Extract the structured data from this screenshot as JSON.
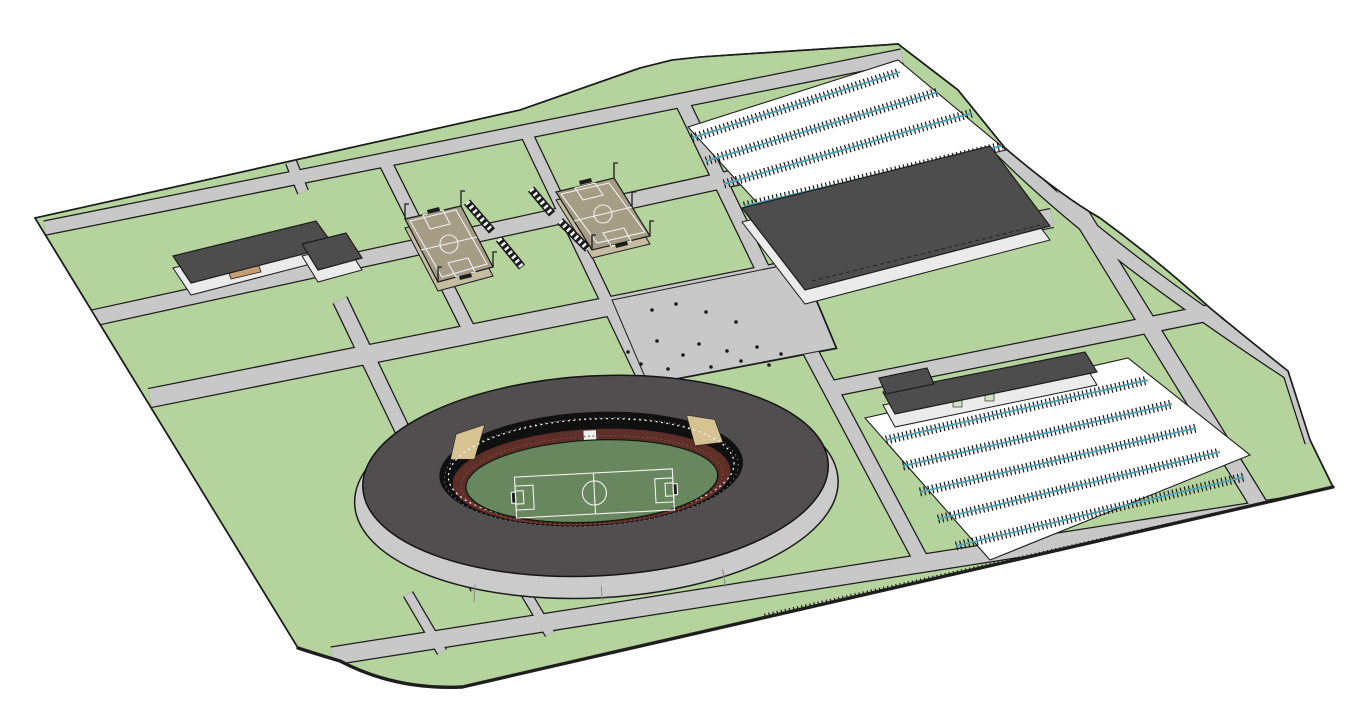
{
  "meta": {
    "title": "Sports complex site plan - 3D model view",
    "view": "axonometric aerial",
    "background_note": "white void around site parcel"
  },
  "colors": {
    "background": "#ffffff",
    "outline": "#1c1c1c",
    "grass": "#b5d39c",
    "road": "#c8c8c8",
    "parking_surface": "#ffffff",
    "parking_lane": "#4ea3b5",
    "stall_ticks": "#161616",
    "roof_dark": "#4d4d4d",
    "wall_light": "#ebebeb",
    "stadium_roof": "#504e4e",
    "stadium_apron": "#cbcbcb",
    "stadium_bowl": "#101010",
    "stadium_seats_maroon": "#5e2e29",
    "stadium_stand_tan": "#d7c291",
    "pitch_green": "#69875f",
    "field_tan": "#a59d85",
    "field_tan_side": "#c6bda1",
    "marking_white": "#f2f2f2",
    "courtyard_tan": "#c59d72",
    "door_green": "#cfe3c2",
    "dot": "#1a1a1a"
  },
  "objects": {
    "site": {
      "label": "Campus parcel with road grid and lawns"
    },
    "stadium": {
      "label": "Main stadium",
      "features": [
        "oval ring roof",
        "tan upper stands",
        "maroon seating tiers",
        "soccer pitch with white markings",
        "perimeter apron"
      ]
    },
    "practice_fields": {
      "label": "Practice soccer fields",
      "count": 2,
      "features": [
        "tan turf",
        "white pitch markings",
        "striped bleachers",
        "floodlight poles"
      ]
    },
    "gymnasium": {
      "label": "Large flat-roof hall (north-east)"
    },
    "school_building": {
      "label": "L-shaped building with courtyard (west)"
    },
    "service_building": {
      "label": "Long low L-shaped building (east)"
    },
    "parking_north": {
      "label": "North parking lot",
      "rows": 5
    },
    "parking_southeast": {
      "label": "South-east parking lot",
      "rows": 5
    },
    "edge_stalls": {
      "label": "Stall row along south-east boundary"
    },
    "pedestrians": {
      "label": "Figures on the stadium forecourt",
      "count": 16
    }
  }
}
